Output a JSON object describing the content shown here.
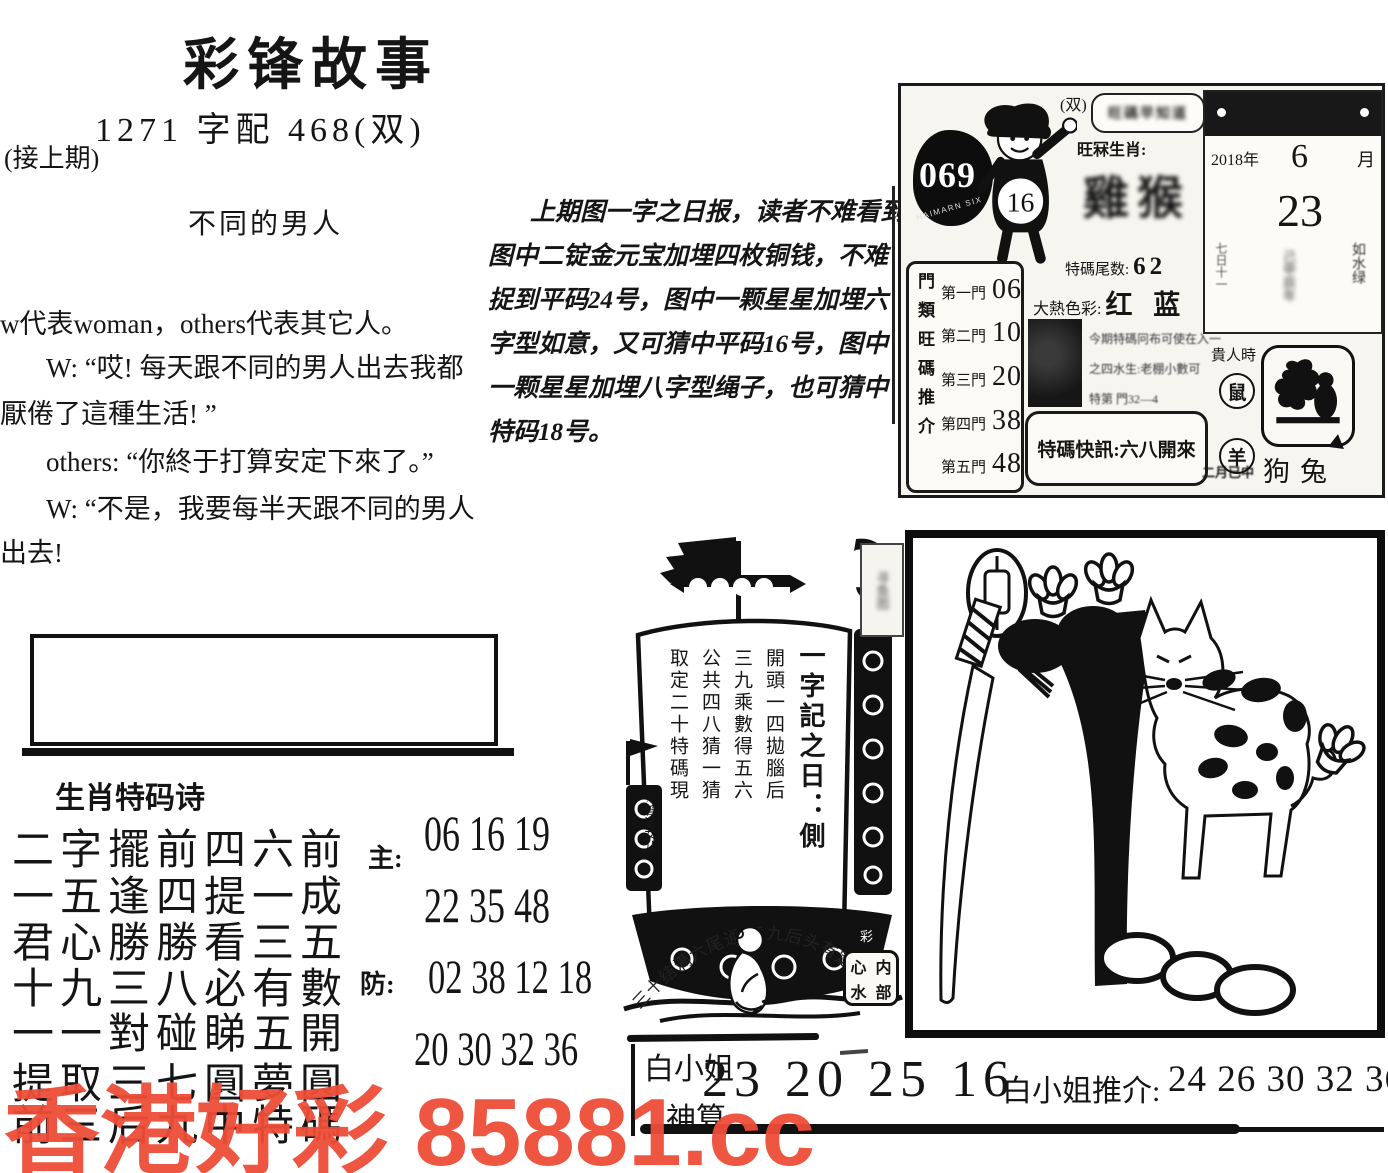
{
  "header": {
    "title": "彩锋故事",
    "issue_line": "1271 字配 468(双)",
    "continuation": "(接上期)",
    "story_title": "不同的男人"
  },
  "story": {
    "lines": [
      "w代表woman，others代表其它人。",
      "W: “哎! 每天跟不同的男人出去我都",
      "厭倦了這種生活! ”",
      "others: “你終于打算安定下來了。”",
      "W: “不是，我要每半天跟不同的男人",
      "出去!"
    ]
  },
  "tip": {
    "lines": [
      "上期图一字之日报，读者不难看到",
      "图中二锭金元宝加埋四枚铜钱，不难",
      "捉到平码24号，图中一颗星星加埋六",
      "字型如意，又可猜中平码16号，图中",
      "一颗星星加埋八字型绳子，也可猜中",
      "特码18号。"
    ]
  },
  "info_box": {
    "issue_number": "069",
    "ring_text": "HAIMARN SIX",
    "boy_number": "16",
    "shuang": "(双)",
    "bubble_scribble": "旺碼早知道",
    "zodiac_label": "旺冧生肖:",
    "zodiac_scribble": "雞猴",
    "tail_label": "特碼尾数:",
    "tail_value": "62",
    "hot_label": "大熱色彩:",
    "hot_value": "红 蓝",
    "door_label": "門類旺碼推介",
    "doors": [
      {
        "label": "第一門",
        "value": "06"
      },
      {
        "label": "第二門",
        "value": "10"
      },
      {
        "label": "第三門",
        "value": "20"
      },
      {
        "label": "第四門",
        "value": "38"
      },
      {
        "label": "第五門",
        "value": "48"
      }
    ],
    "blur_lines": [
      "今期特碼冋布可使在入一",
      "之四水生:老棚小數可",
      "特第 門32—4"
    ],
    "kuaixun": "特碼快訊:六八開來",
    "guiren": "貴人時",
    "circle_rat": "鼠",
    "circle_goat": "羊",
    "month_note": "二月已中",
    "month_animals": "狗兔",
    "calendar": {
      "year": "2018年",
      "month": "6",
      "month_char": "月",
      "day": "23",
      "note_left": "七日十一",
      "note_center": "己甲辰年",
      "note_right": "如水绿"
    }
  },
  "poem": {
    "heading": "生肖特码诗",
    "lines": [
      "二字擺前四六前",
      "一五逢四提一成",
      "君心勝勝看三五",
      "十九三八必有數",
      "一一對碰睇五開",
      "提取三七圓夢圓",
      "前三后九中特碼"
    ],
    "main_label": "主:",
    "main_rows": [
      "06 16 19",
      "22 35 48"
    ],
    "guard_label": "防:",
    "guard_rows": [
      "02 38 12 18",
      "20 30 32 36"
    ]
  },
  "boat": {
    "sail_cols": [
      "一字記之日：側",
      "開頭一四拋腦后",
      "三九乘數得五六",
      "公共四八猜一猜",
      "取定二十特碼現"
    ],
    "sail_sign": "※曾道女儿",
    "arc_text": "三十结满六尾通,二九后头有定数",
    "seal_chars": [
      "心",
      "内",
      "水",
      "部"
    ],
    "stamp_text": "寻鱼图",
    "hull_mark": "彩"
  },
  "bottom": {
    "lady": "白小姐",
    "suan": "神算",
    "numbers_main": "23 20 25 16",
    "tui_label": "白小姐推介:",
    "numbers_tui": "24 26 30 32 36"
  },
  "watermark": {
    "text": "香港好彩 85881.cc",
    "color": "#ee4d38"
  },
  "colors": {
    "ink": "#111111",
    "watermark_red": "#ee4d38"
  }
}
